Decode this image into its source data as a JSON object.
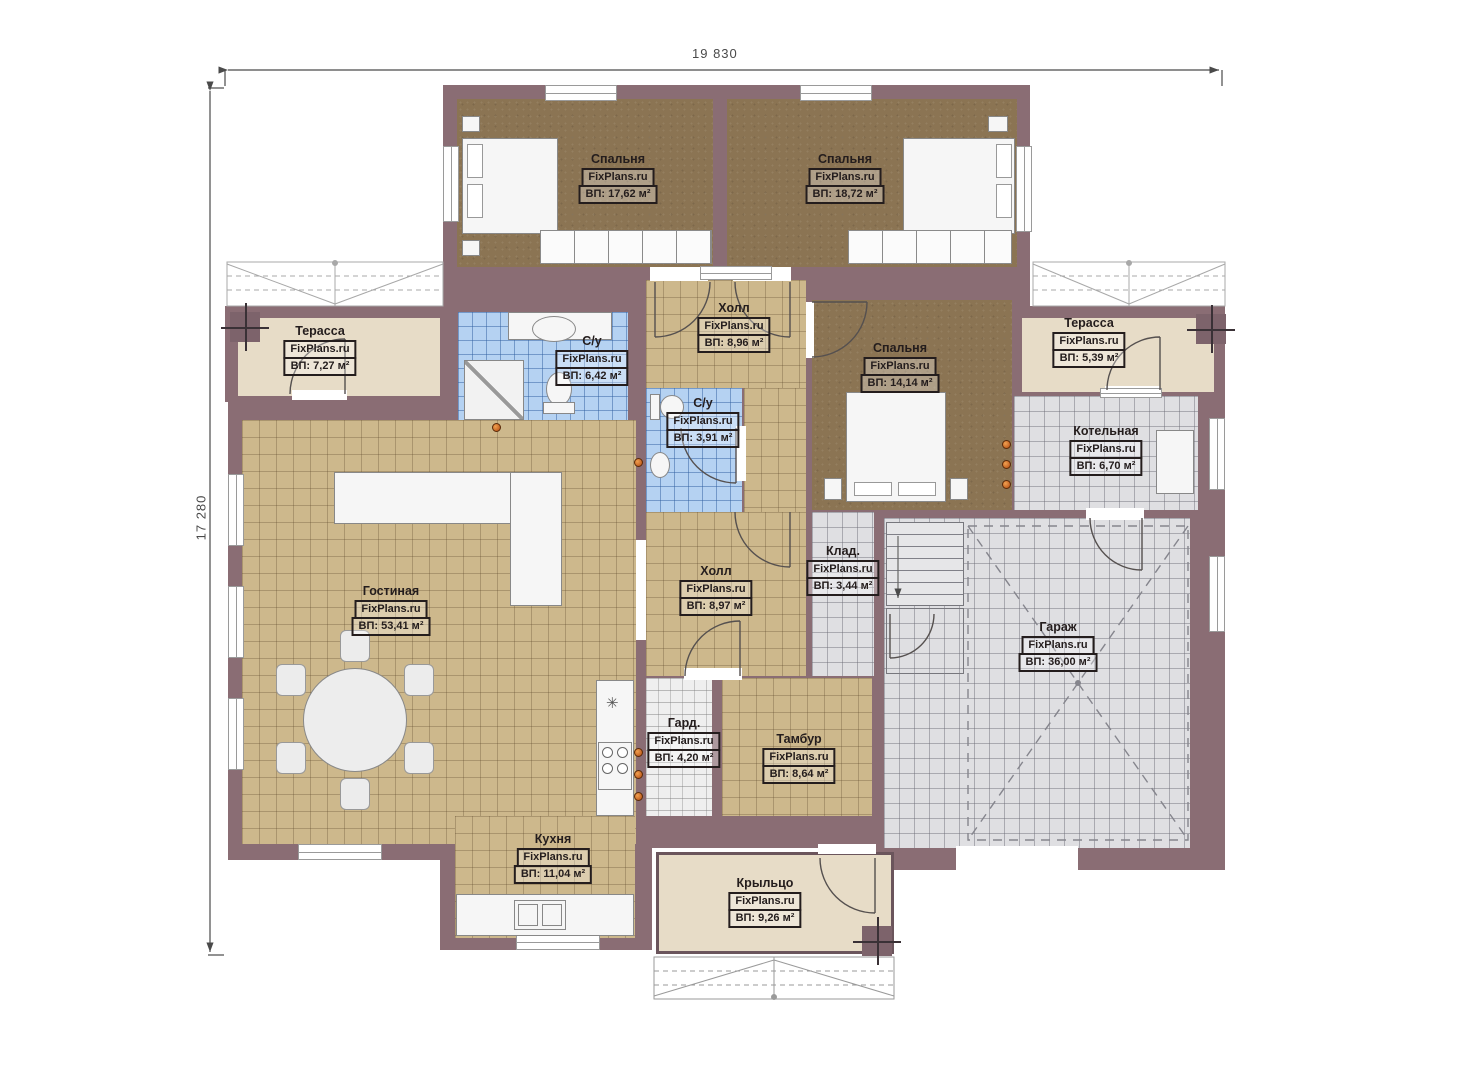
{
  "watermark": "FixPlans.ru",
  "dimensions": {
    "top": "19 830",
    "left": "17 280"
  },
  "colors": {
    "wall": "#8a6d74",
    "floor_wood": "#cdb88c",
    "floor_bedroom": "#8b7453",
    "tile_bath": "#b5d2f2",
    "tile_utility": "#dfdfe2",
    "terrace": "#e7dcc7",
    "radiator": "#c35f1f"
  },
  "rooms": [
    {
      "id": "bedroom-1",
      "name": "Спальня",
      "area": "ВП: 17,62 м²"
    },
    {
      "id": "bedroom-2",
      "name": "Спальня",
      "area": "ВП: 18,72 м²"
    },
    {
      "id": "terrace-left",
      "name": "Терасса",
      "area": "ВП: 7,27 м²"
    },
    {
      "id": "bathroom-1",
      "name": "С/у",
      "area": "ВП: 6,42 м²"
    },
    {
      "id": "hall-top",
      "name": "Холл",
      "area": "ВП: 8,96 м²"
    },
    {
      "id": "bedroom-3",
      "name": "Спальня",
      "area": "ВП: 14,14 м²"
    },
    {
      "id": "terrace-right",
      "name": "Терасса",
      "area": "ВП: 5,39 м²"
    },
    {
      "id": "boiler-room",
      "name": "Котельная",
      "area": "ВП: 6,70 м²"
    },
    {
      "id": "bathroom-2",
      "name": "С/у",
      "area": "ВП: 3,91 м²"
    },
    {
      "id": "living-room",
      "name": "Гостиная",
      "area": "ВП: 53,41 м²"
    },
    {
      "id": "hall-mid",
      "name": "Холл",
      "area": "ВП: 8,97 м²"
    },
    {
      "id": "storage",
      "name": "Клад.",
      "area": "ВП: 3,44 м²"
    },
    {
      "id": "garage",
      "name": "Гараж",
      "area": "ВП: 36,00 м²"
    },
    {
      "id": "wardrobe-room",
      "name": "Гард.",
      "area": "ВП: 4,20 м²"
    },
    {
      "id": "tambour",
      "name": "Тамбур",
      "area": "ВП: 8,64 м²"
    },
    {
      "id": "kitchen",
      "name": "Кухня",
      "area": "ВП: 11,04 м²"
    },
    {
      "id": "porch",
      "name": "Крыльцо",
      "area": "ВП: 9,26 м²"
    }
  ]
}
